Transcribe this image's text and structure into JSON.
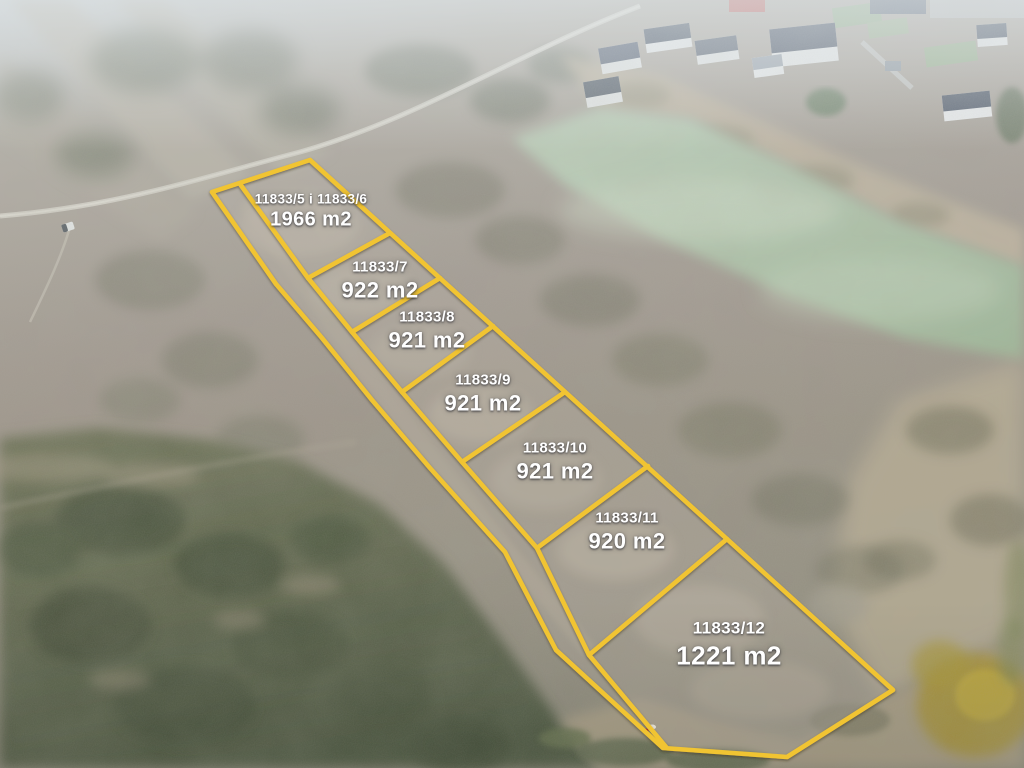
{
  "overlay": {
    "line_color": "#F1C433",
    "label_text_color": "#FFFFFF"
  },
  "parcels": [
    {
      "plot": "11833/5 i 11833/6",
      "area": "1966 m2"
    },
    {
      "plot": "11833/7",
      "area": "922 m2"
    },
    {
      "plot": "11833/8",
      "area": "921 m2"
    },
    {
      "plot": "11833/9",
      "area": "921 m2"
    },
    {
      "plot": "11833/10",
      "area": "921 m2"
    },
    {
      "plot": "11833/11",
      "area": "920 m2"
    },
    {
      "plot": "11833/12",
      "area": "1221 m2"
    }
  ]
}
